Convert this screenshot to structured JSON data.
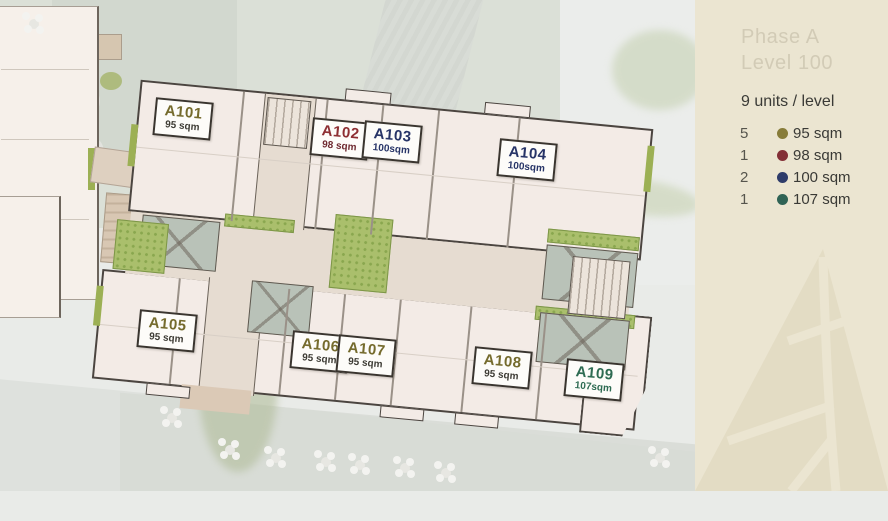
{
  "sidebar": {
    "title_line1": "Phase A",
    "title_line2": "Level 100",
    "units_summary": "9 units / level",
    "legend": [
      {
        "count": "5",
        "label": "95 sqm",
        "color": "#877c39"
      },
      {
        "count": "1",
        "label": "98 sqm",
        "color": "#832f36"
      },
      {
        "count": "2",
        "label": "100 sqm",
        "color": "#2e3c6a"
      },
      {
        "count": "1",
        "label": "107 sqm",
        "color": "#2f6355"
      }
    ]
  },
  "plan": {
    "units": [
      {
        "id": "A101",
        "area": "95 sqm",
        "color": "#756b2d",
        "area_color": "#3e3c35"
      },
      {
        "id": "A102",
        "area": "98 sqm",
        "color": "#8e2f33",
        "area_color": "#6f2a30"
      },
      {
        "id": "A103",
        "area": "100sqm",
        "color": "#273467",
        "area_color": "#273467"
      },
      {
        "id": "A104",
        "area": "100sqm",
        "color": "#273467",
        "area_color": "#273467"
      },
      {
        "id": "A105",
        "area": "95 sqm",
        "color": "#756b2d",
        "area_color": "#3e3c35"
      },
      {
        "id": "A106",
        "area": "95 sqm",
        "color": "#756b2d",
        "area_color": "#3e3c35"
      },
      {
        "id": "A107",
        "area": "95 sqm",
        "color": "#756b2d",
        "area_color": "#3e3c35"
      },
      {
        "id": "A108",
        "area": "95 sqm",
        "color": "#756b2d",
        "area_color": "#3e3c35"
      },
      {
        "id": "A109",
        "area": "107sqm",
        "color": "#2e6b52",
        "area_color": "#2e6b52"
      }
    ]
  }
}
